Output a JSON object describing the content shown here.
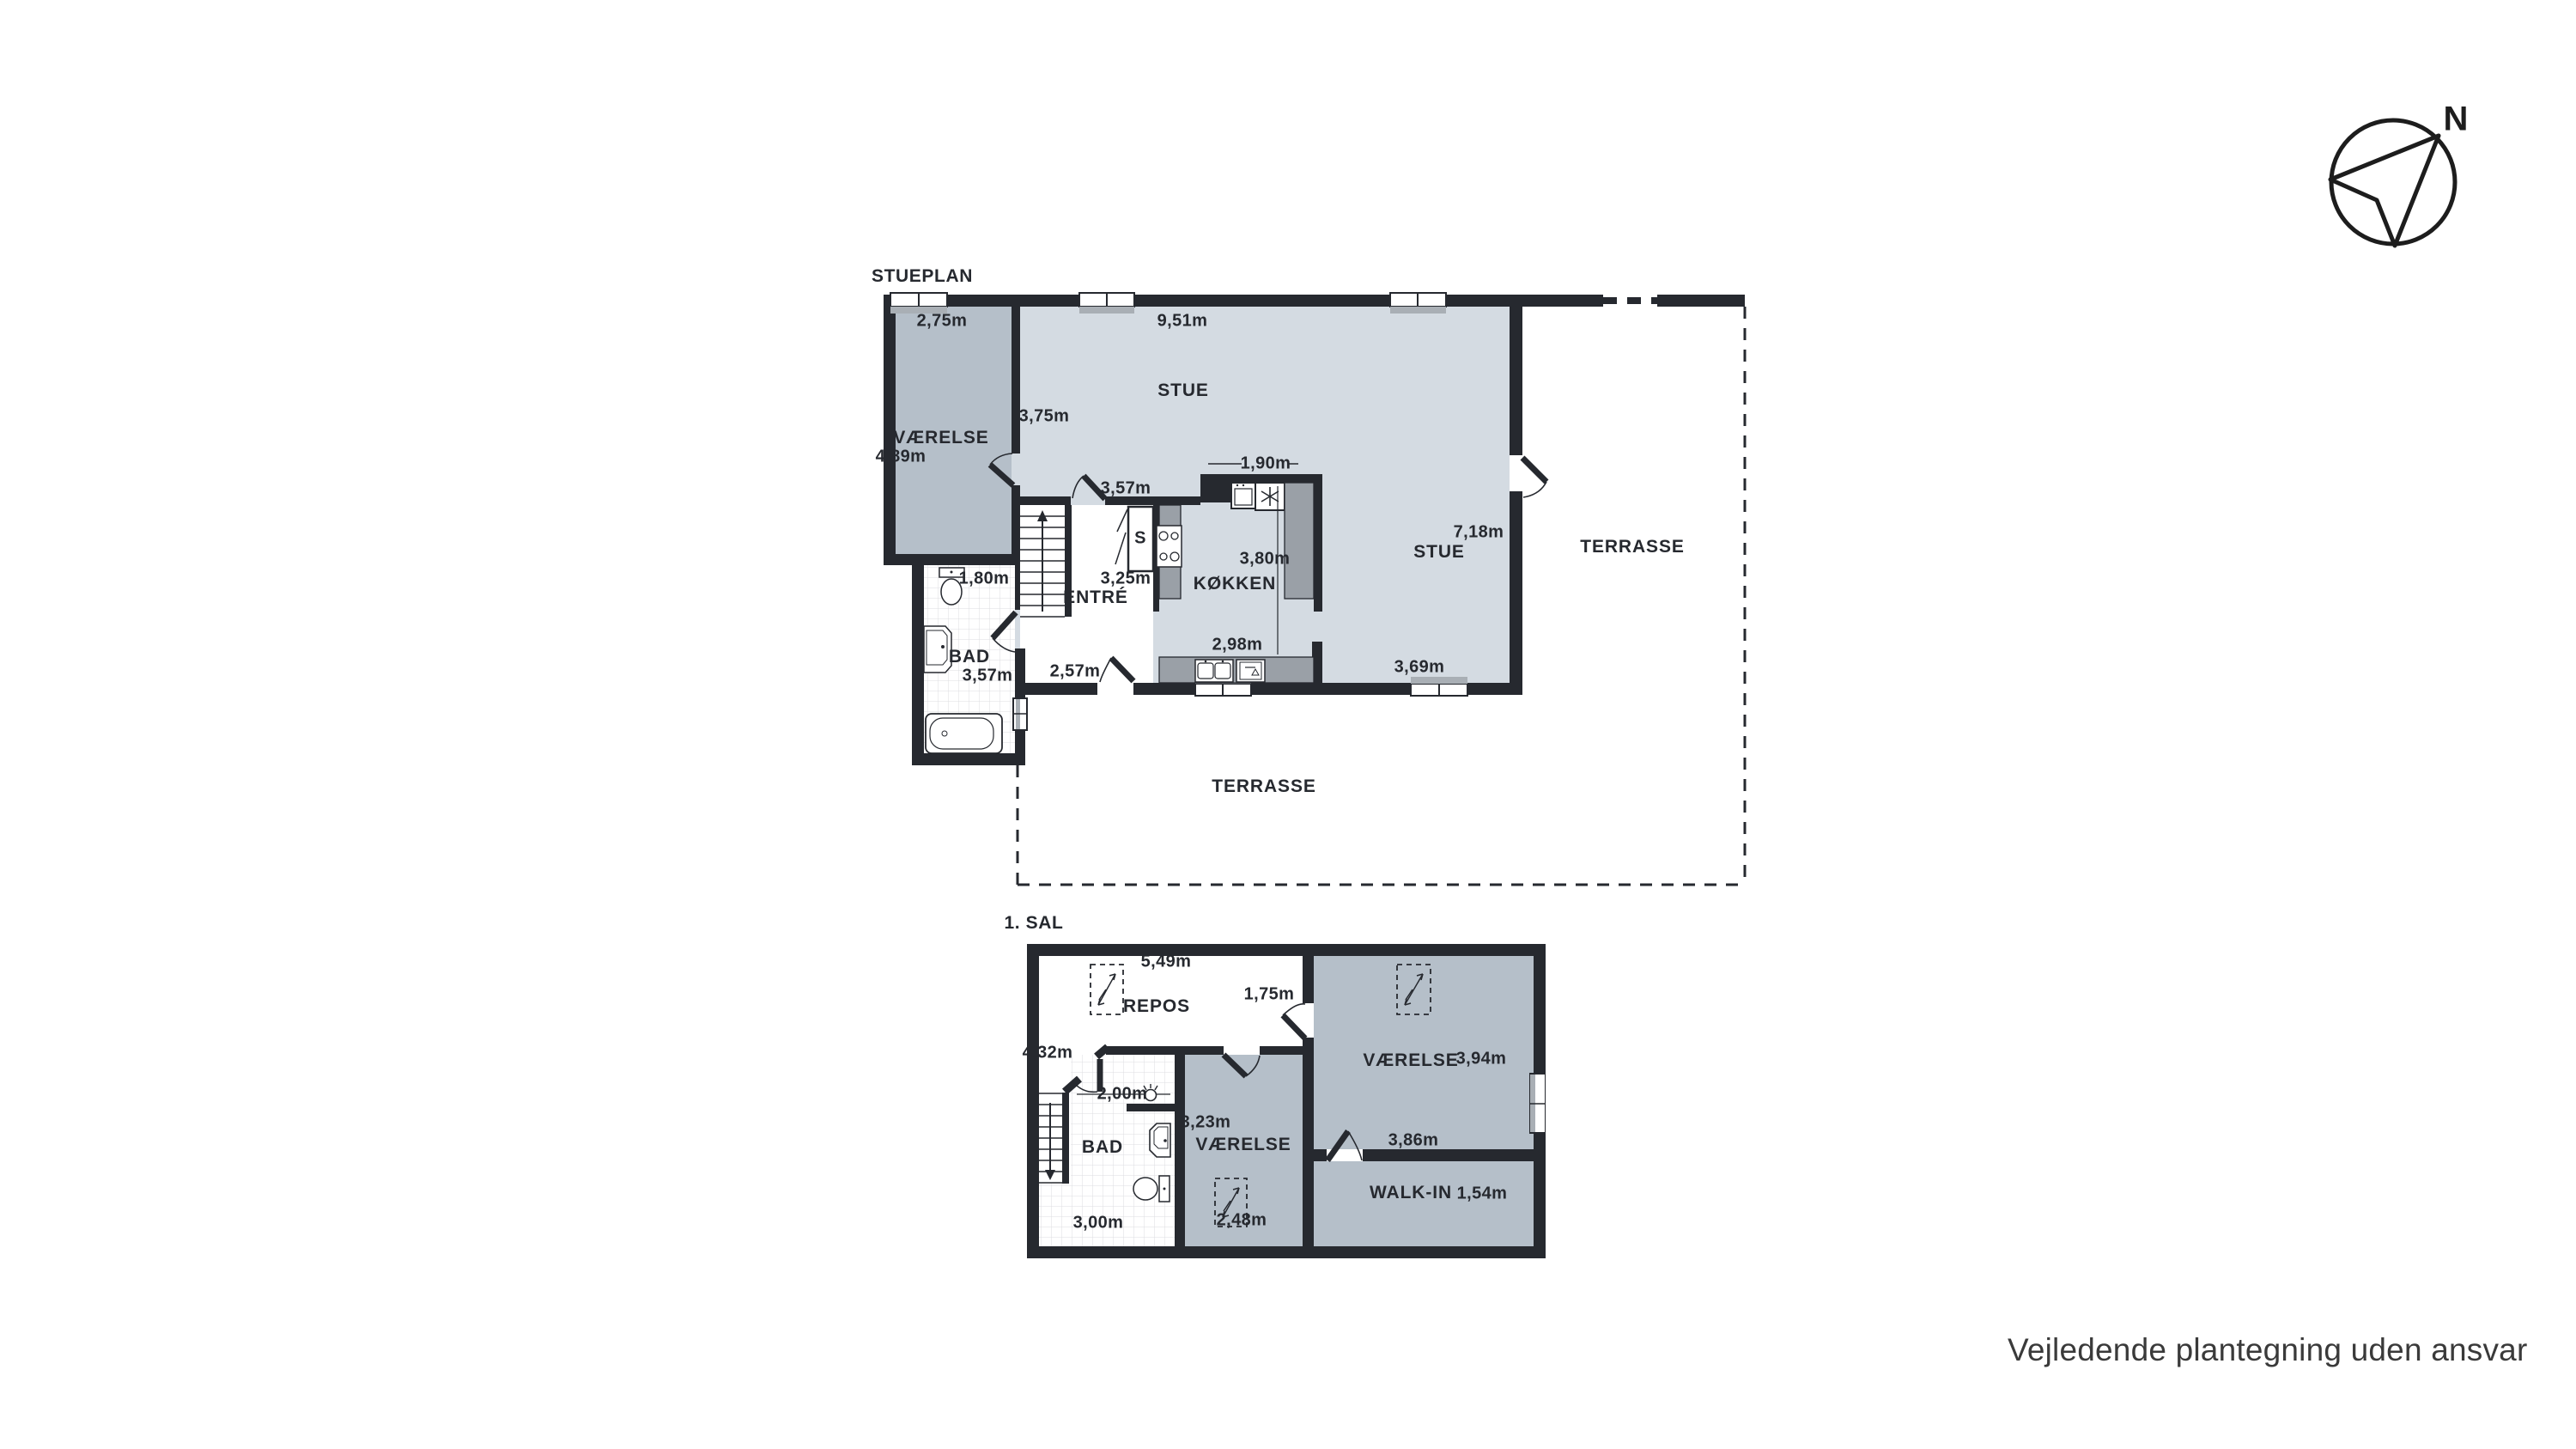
{
  "ground": {
    "title": "STUEPLAN",
    "rooms": {
      "vaerelse": "VÆRELSE",
      "stue": "STUE",
      "stue2": "STUE",
      "koekken": "KØKKEN",
      "entre": "ENTRÉ",
      "bad": "BAD",
      "closet": "S",
      "terrasse_right": "TERRASSE",
      "terrasse_bottom": "TERRASSE"
    },
    "dims": {
      "vaerelse_w": "2,75m",
      "stue_w": "9,51m",
      "vaerelse_h": "4,89m",
      "stue_h": "3,75m",
      "stue_door": "3,57m",
      "island_w": "1,90m",
      "stue2_h": "7,18m",
      "koekken_h": "3,80m",
      "entre_h": "3,25m",
      "koekken_w": "2,98m",
      "entre_w": "2,57m",
      "bad_w": "1,80m",
      "bad_h": "3,57m",
      "stue2_w": "3,69m"
    }
  },
  "first": {
    "title": "1. SAL",
    "rooms": {
      "repos": "REPOS",
      "bad": "BAD",
      "vaerelse_mid": "VÆRELSE",
      "vaerelse_right": "VÆRELSE",
      "walkin": "WALK-IN"
    },
    "dims": {
      "repos_w": "5,49m",
      "repos_door": "1,75m",
      "repos_h": "4,32m",
      "bad_door": "2,00m",
      "vaerelse_mid_w": "3,23m",
      "vaerelse_right_h": "3,94m",
      "door_wall_w": "3,86m",
      "bad_w": "3,00m",
      "skylight_w": "2,48m",
      "walkin_h": "1,54m"
    }
  },
  "compass": {
    "label": "N"
  },
  "footer": {
    "disclaimer": "Vejledende plantegning uden ansvar"
  },
  "colors": {
    "wall": "#26292f",
    "room_light": "#d4dbe2",
    "room_medium": "#b5bfc9",
    "counter": "#9aa0a7",
    "window_sill": "#a9afb5",
    "tile_line": "#dcdee0"
  }
}
